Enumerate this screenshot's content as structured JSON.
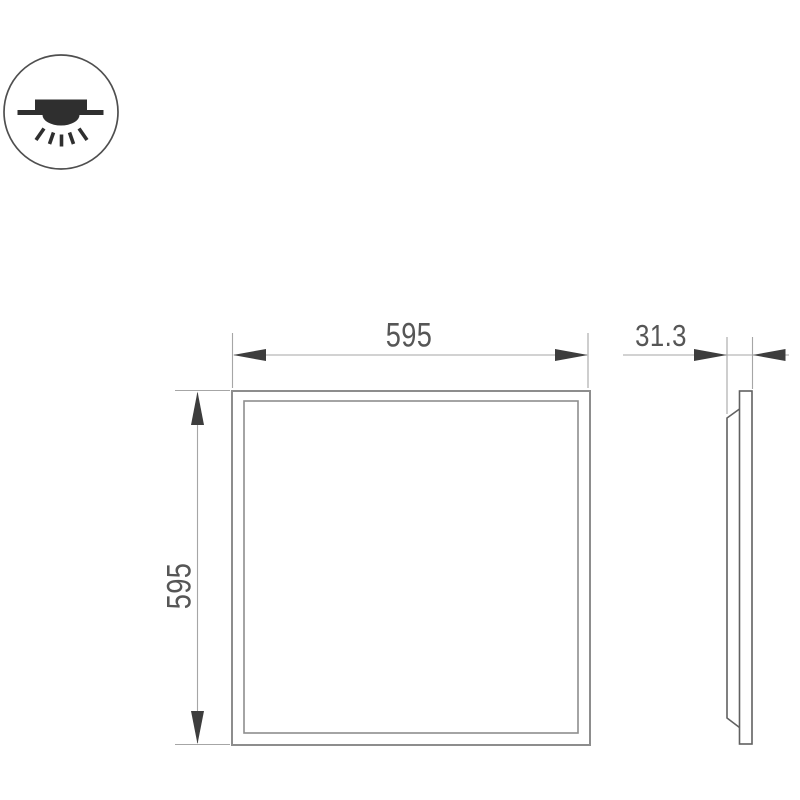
{
  "dimensions": {
    "front_width": "595",
    "front_height": "595",
    "side_depth": "31.3"
  },
  "icons": {
    "mount": "recessed-ceiling-light-icon"
  },
  "colors": {
    "background": "#ffffff",
    "outline": "#8d8d8d",
    "thin_line": "#a6a6a6",
    "arrow": "#3d3d3d",
    "profile": "#616161",
    "text": "#565656",
    "icon": "#2f2f2f",
    "icon_outline": "#4f4f4f"
  }
}
